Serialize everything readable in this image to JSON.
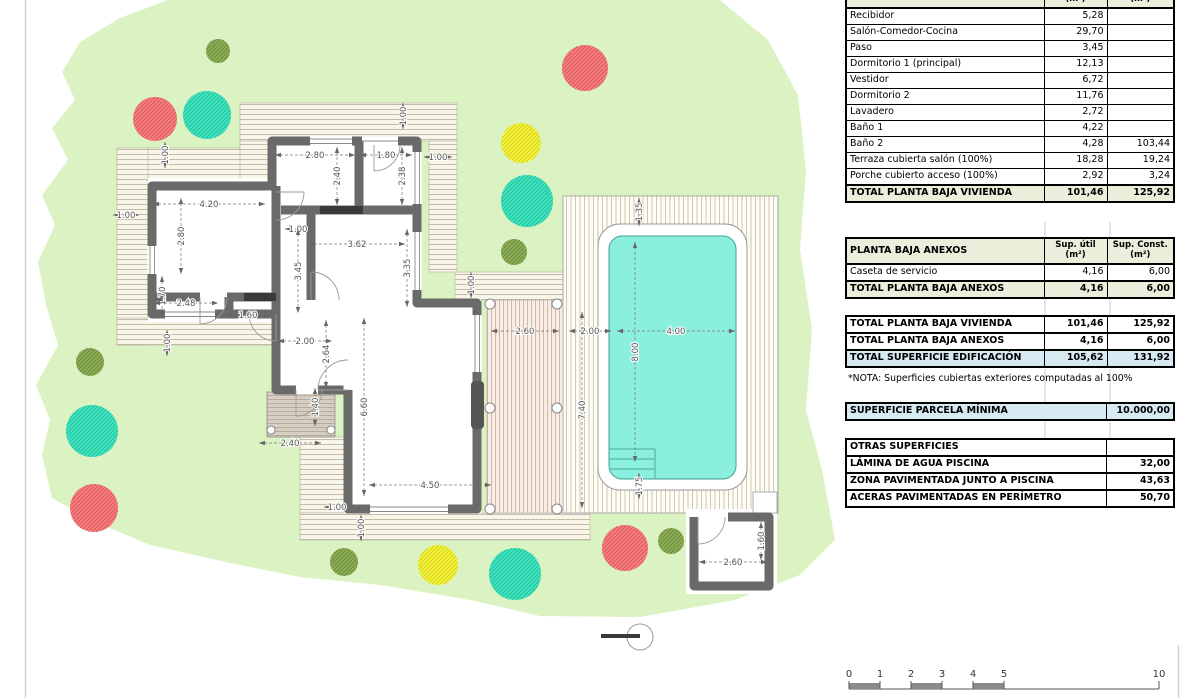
{
  "note": "*NOTA: Superficies cubiertas exteriores computadas al 100%",
  "note_top": 373,
  "tables": [
    {
      "name": "planta-baja-vivienda",
      "top": -19,
      "type": "3col",
      "header": {
        "label": "PLANTA BAJA VIVIENDA",
        "col1": "Sup. útil|(m²)",
        "col2": "Sup. Const.|(m²)"
      },
      "rows": [
        {
          "label": "Recibidor",
          "v1": "5,28",
          "v2": ""
        },
        {
          "label": "Salón-Comedor-Cocina",
          "v1": "29,70",
          "v2": ""
        },
        {
          "label": "Paso",
          "v1": "3,45",
          "v2": ""
        },
        {
          "label": "Dormitorio 1 (principal)",
          "v1": "12,13",
          "v2": ""
        },
        {
          "label": "Vestidor",
          "v1": "6,72",
          "v2": ""
        },
        {
          "label": "Dormitorio 2",
          "v1": "11,76",
          "v2": ""
        },
        {
          "label": "Lavadero",
          "v1": "2,72",
          "v2": ""
        },
        {
          "label": "Baño 1",
          "v1": "4,22",
          "v2": ""
        },
        {
          "label": "Baño 2",
          "v1": "4,28",
          "v2": "103,44"
        },
        {
          "label": "Terraza cubierta salón (100%)",
          "v1": "18,28",
          "v2": "19,24"
        },
        {
          "label": "Porche cubierto acceso (100%)",
          "v1": "2,92",
          "v2": "3,24"
        },
        {
          "label": "TOTAL PLANTA BAJA VIVIENDA",
          "v1": "101,46",
          "v2": "125,92",
          "style": "total"
        }
      ]
    },
    {
      "name": "planta-baja-anexos",
      "top": 237,
      "type": "3col",
      "header": {
        "label": "PLANTA BAJA ANEXOS",
        "col1": "Sup. útil|(m²)",
        "col2": "Sup. Const.|(m²)"
      },
      "rows": [
        {
          "label": "Caseta de servicio",
          "v1": "4,16",
          "v2": "6,00"
        },
        {
          "label": "TOTAL PLANTA BAJA ANEXOS",
          "v1": "4,16",
          "v2": "6,00",
          "style": "total"
        }
      ]
    },
    {
      "name": "totales",
      "top": 315,
      "type": "3col",
      "header": null,
      "rows": [
        {
          "label": "TOTAL PLANTA BAJA VIVIENDA",
          "v1": "101,46",
          "v2": "125,92",
          "style": "bold"
        },
        {
          "label": "TOTAL PLANTA BAJA ANEXOS",
          "v1": "4,16",
          "v2": "6,00",
          "style": "bold"
        },
        {
          "label": "TOTAL SUPERFICIE EDIFICACIÓN",
          "v1": "105,62",
          "v2": "131,92",
          "style": "blue"
        }
      ]
    },
    {
      "name": "parcela-minima",
      "top": 402,
      "type": "2col",
      "header": null,
      "rows": [
        {
          "label": "SUPERFICIE PARCELA MÍNIMA",
          "v1": "10.000,00",
          "style": "blue"
        }
      ]
    },
    {
      "name": "otras-superficies",
      "top": 438,
      "type": "2col",
      "header": null,
      "rows": [
        {
          "label": "OTRAS SUPERFICIES",
          "v1": "",
          "style": "bold"
        },
        {
          "label": "LÁMINA DE AGUA PISCINA",
          "v1": "32,00",
          "style": "bold"
        },
        {
          "label": "ZONA PAVIMENTADA JUNTO A PISCINA",
          "v1": "43,63",
          "style": "bold"
        },
        {
          "label": "ACERAS PAVIMENTADAS EN PERÍMETRO",
          "v1": "50,70",
          "style": "bold"
        }
      ]
    }
  ],
  "plan": {
    "colors": {
      "parcel_green": "#DBF3C3",
      "wall_gray": "#6A6A6A",
      "pool_water": "#8BEFDE",
      "table_header": "#EDEDDB",
      "table_blue": "#D8EAF1",
      "dim_text": "#555555"
    },
    "dimensions": [
      {
        "x": 315,
        "y": 151,
        "t": "2.80",
        "v": 0,
        "len": 80
      },
      {
        "x": 386,
        "y": 151,
        "t": "1.80",
        "v": 0,
        "len": 52
      },
      {
        "x": 438,
        "y": 153,
        "t": "1.00",
        "v": 0,
        "len": 28
      },
      {
        "x": 399,
        "y": 116,
        "t": "1.00",
        "v": 1,
        "len": 26
      },
      {
        "x": 161,
        "y": 155,
        "t": "1.00",
        "v": 1,
        "len": 26
      },
      {
        "x": 333,
        "y": 176,
        "t": "2.40",
        "v": 1,
        "len": 58
      },
      {
        "x": 398,
        "y": 176,
        "t": "2.38",
        "v": 1,
        "len": 58
      },
      {
        "x": 209,
        "y": 200,
        "t": "4.20",
        "v": 0,
        "len": 112
      },
      {
        "x": 126,
        "y": 211,
        "t": "1.00",
        "v": 0,
        "len": 26
      },
      {
        "x": 177,
        "y": 236,
        "t": "2.80",
        "v": 1,
        "len": 76
      },
      {
        "x": 298,
        "y": 225,
        "t": "1.00",
        "v": 0,
        "len": 26
      },
      {
        "x": 357,
        "y": 240,
        "t": "3.62",
        "v": 0,
        "len": 96
      },
      {
        "x": 294,
        "y": 271,
        "t": "3.45",
        "v": 1,
        "len": 84
      },
      {
        "x": 403,
        "y": 268,
        "t": "3.35",
        "v": 1,
        "len": 78
      },
      {
        "x": 158,
        "y": 296,
        "t": "1.70",
        "v": 1,
        "len": 40
      },
      {
        "x": 186,
        "y": 299,
        "t": "2.48",
        "v": 0,
        "len": 64
      },
      {
        "x": 248,
        "y": 311,
        "t": "1.60",
        "v": 0,
        "len": 44
      },
      {
        "x": 467,
        "y": 285,
        "t": "1.00",
        "v": 1,
        "len": 26
      },
      {
        "x": 163,
        "y": 343,
        "t": "1.00",
        "v": 1,
        "len": 26
      },
      {
        "x": 305,
        "y": 337,
        "t": "2.00",
        "v": 0,
        "len": 54
      },
      {
        "x": 322,
        "y": 354,
        "t": "2.64",
        "v": 1,
        "len": 68
      },
      {
        "x": 290,
        "y": 439,
        "t": "2.40",
        "v": 0,
        "len": 62
      },
      {
        "x": 311,
        "y": 407,
        "t": "1.40",
        "v": 1,
        "len": 38
      },
      {
        "x": 360,
        "y": 407,
        "t": "6.60",
        "v": 1,
        "len": 178
      },
      {
        "x": 430,
        "y": 481,
        "t": "4.50",
        "v": 0,
        "len": 122
      },
      {
        "x": 337,
        "y": 503,
        "t": "1.00",
        "v": 0,
        "len": 26
      },
      {
        "x": 357,
        "y": 528,
        "t": "1.00",
        "v": 1,
        "len": 26
      },
      {
        "x": 525,
        "y": 327,
        "t": "2.60",
        "v": 0,
        "len": 68
      },
      {
        "x": 590,
        "y": 327,
        "t": "2.00",
        "v": 0,
        "len": 42
      },
      {
        "x": 676,
        "y": 327,
        "t": "4.00",
        "v": 0,
        "len": 118
      },
      {
        "x": 578,
        "y": 410,
        "t": "7.40",
        "v": 1,
        "len": 196
      },
      {
        "x": 631,
        "y": 352,
        "t": "8.00",
        "v": 1,
        "len": 220
      },
      {
        "x": 635,
        "y": 212,
        "t": "1.35",
        "v": 1,
        "len": 28
      },
      {
        "x": 635,
        "y": 486,
        "t": "1.75",
        "v": 1,
        "len": 26
      },
      {
        "x": 733,
        "y": 558,
        "t": "2.60",
        "v": 0,
        "len": 68
      },
      {
        "x": 757,
        "y": 541,
        "t": "1.60",
        "v": 1,
        "len": 38
      }
    ],
    "trees": [
      {
        "x": 218,
        "y": 51,
        "r": 12,
        "type": "olive"
      },
      {
        "x": 155,
        "y": 119,
        "r": 22,
        "type": "red"
      },
      {
        "x": 207,
        "y": 115,
        "r": 24,
        "type": "teal"
      },
      {
        "x": 585,
        "y": 68,
        "r": 23,
        "type": "red"
      },
      {
        "x": 521,
        "y": 143,
        "r": 20,
        "type": "yellow"
      },
      {
        "x": 527,
        "y": 201,
        "r": 26,
        "type": "teal"
      },
      {
        "x": 514,
        "y": 252,
        "r": 13,
        "type": "olive"
      },
      {
        "x": 90,
        "y": 362,
        "r": 14,
        "type": "olive"
      },
      {
        "x": 92,
        "y": 431,
        "r": 26,
        "type": "teal"
      },
      {
        "x": 94,
        "y": 508,
        "r": 24,
        "type": "red"
      },
      {
        "x": 344,
        "y": 562,
        "r": 14,
        "type": "olive"
      },
      {
        "x": 438,
        "y": 565,
        "r": 20,
        "type": "yellow"
      },
      {
        "x": 515,
        "y": 574,
        "r": 26,
        "type": "teal"
      },
      {
        "x": 625,
        "y": 548,
        "r": 23,
        "type": "red"
      },
      {
        "x": 671,
        "y": 541,
        "r": 13,
        "type": "olive"
      }
    ],
    "tree_palette": {
      "red": {
        "fill": "#F47D7D",
        "hatch": "#E05B5B"
      },
      "teal": {
        "fill": "#3EE2BD",
        "hatch": "#27C4A1"
      },
      "yellow": {
        "fill": "#F3F13C",
        "hatch": "#D9D41E"
      },
      "olive": {
        "fill": "#8CAB57",
        "hatch": "#6F9140"
      }
    },
    "scale_bar": {
      "x0": 849,
      "px_per_m": 31,
      "baseline_y": 689,
      "ticks": [
        {
          "label": "0",
          "m": 0
        },
        {
          "label": "1",
          "m": 1
        },
        {
          "label": "2",
          "m": 2
        },
        {
          "label": "3",
          "m": 3
        },
        {
          "label": "4",
          "m": 4
        },
        {
          "label": "5",
          "m": 5
        },
        {
          "label": "10",
          "m": 10
        }
      ],
      "filled_segments": [
        [
          0,
          1
        ],
        [
          2,
          3
        ],
        [
          4,
          5
        ]
      ]
    }
  }
}
